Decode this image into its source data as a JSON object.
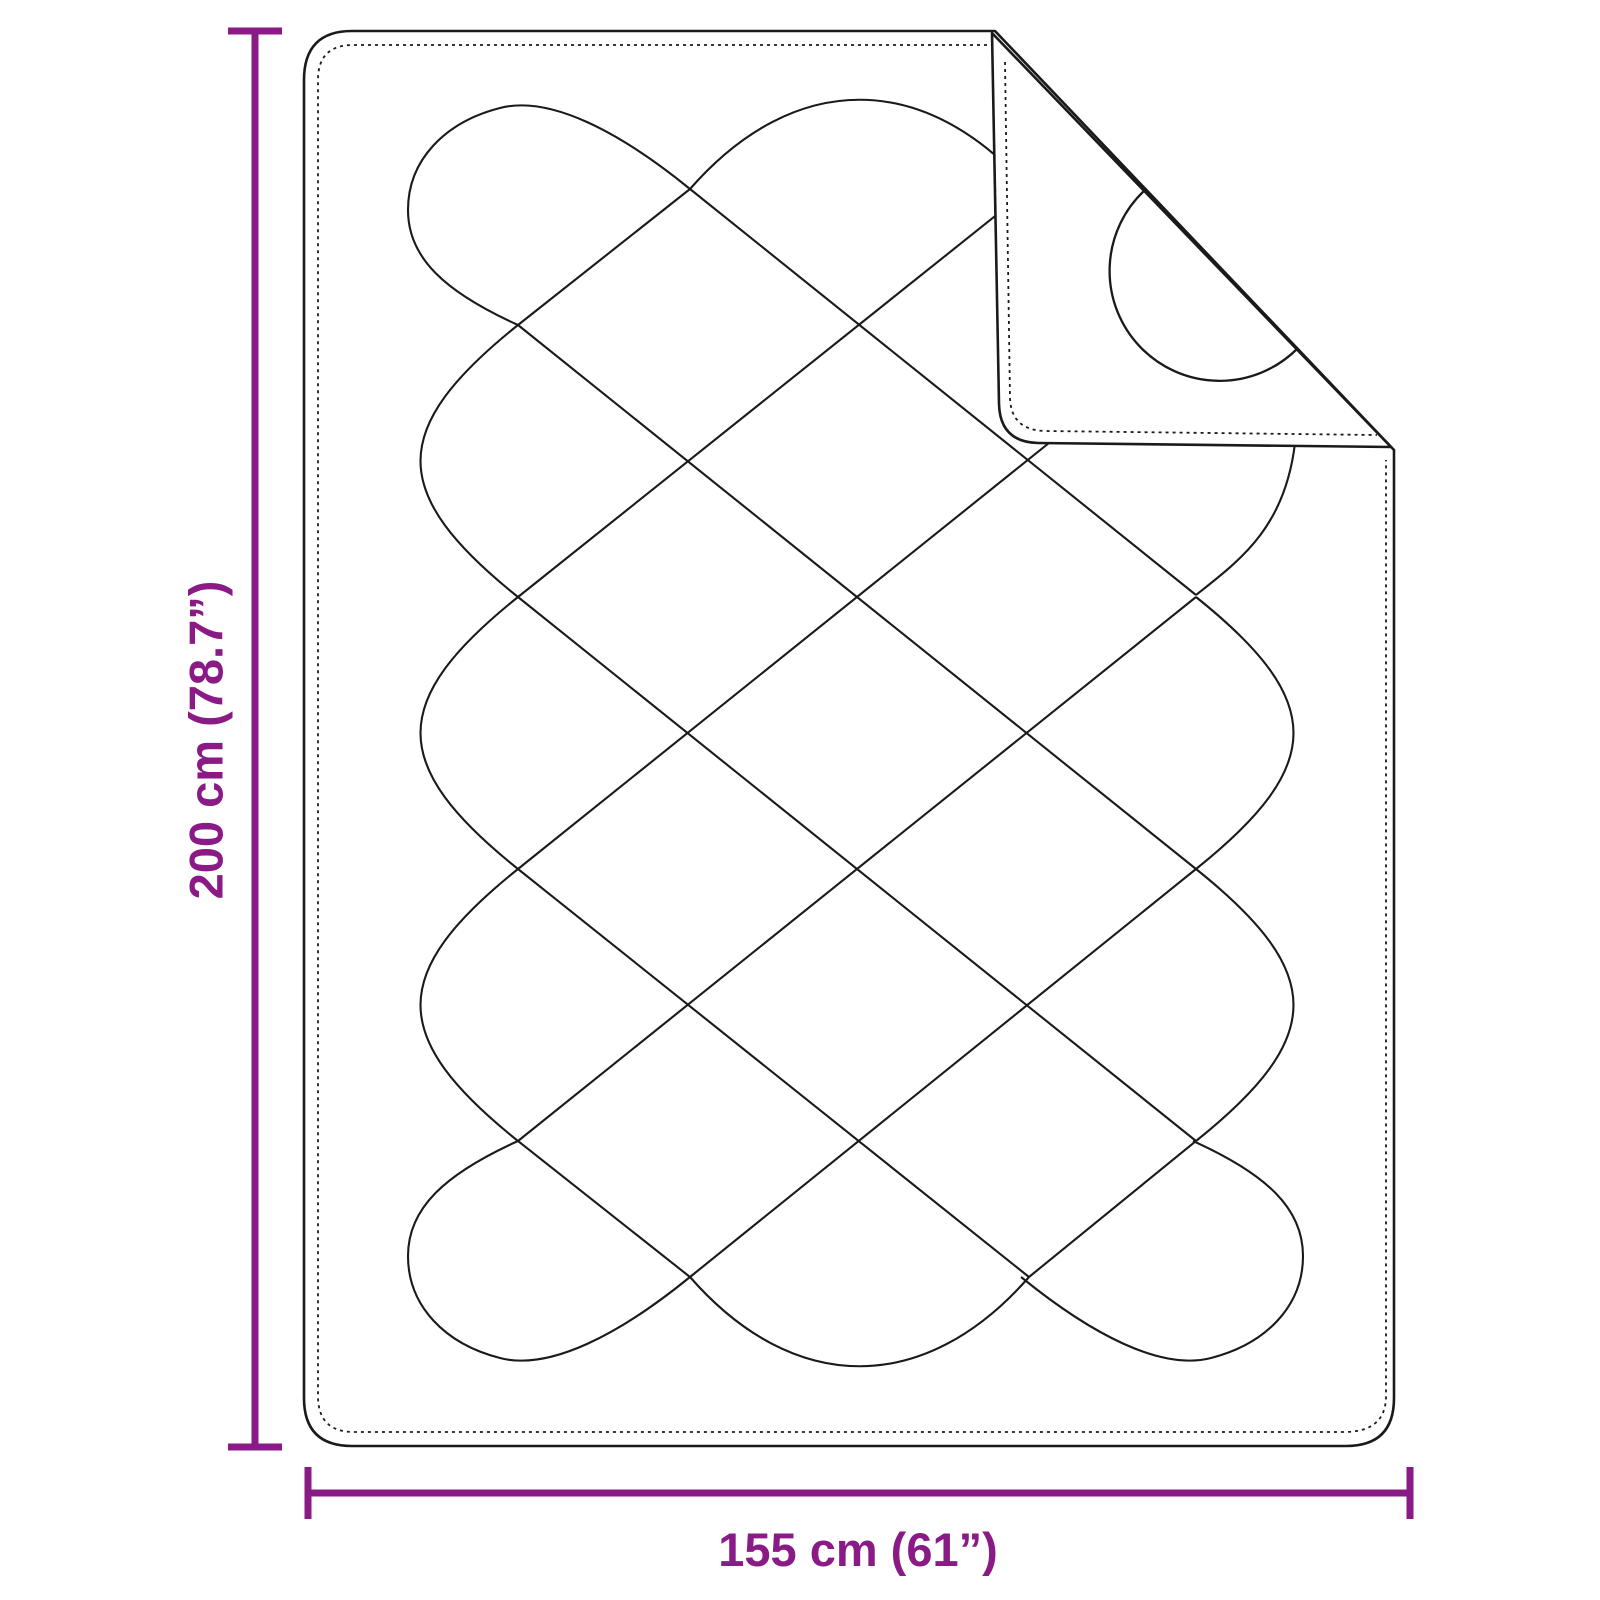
{
  "dimensions": {
    "height_label": "200 cm (78.7”)",
    "width_label": "155 cm (61”)"
  },
  "colors": {
    "dimension": "#8A1A86",
    "line": "#1A1A1A",
    "background": "#FFFFFF"
  }
}
